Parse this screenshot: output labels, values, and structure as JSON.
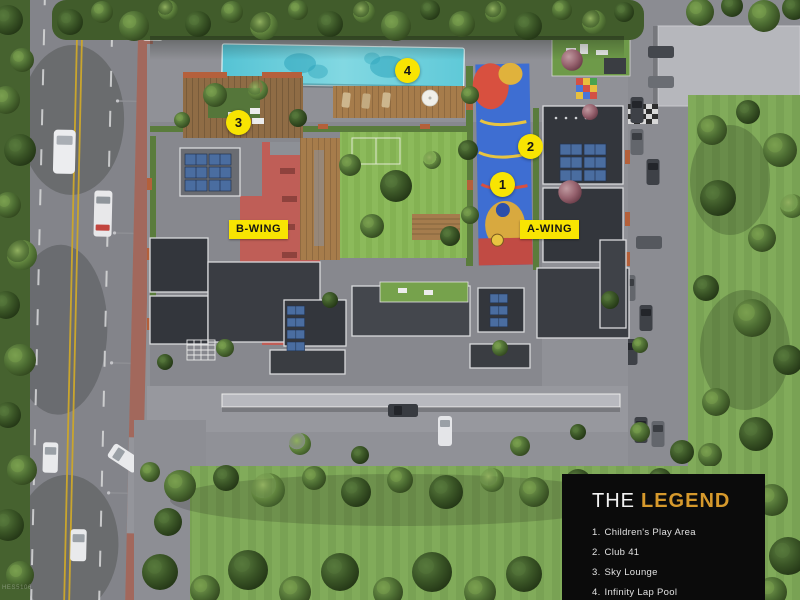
{
  "page": {
    "type": "aerial-site-plan-render"
  },
  "wings": [
    {
      "label": "B-WING"
    },
    {
      "label": "A-WING"
    }
  ],
  "markers": [
    {
      "number": "1"
    },
    {
      "number": "2"
    },
    {
      "number": "3"
    },
    {
      "number": "4"
    }
  ],
  "legend": {
    "title_prefix": "THE",
    "title_accent": "LEGEND",
    "items": [
      {
        "number": "1.",
        "label": "Children's Play Area"
      },
      {
        "number": "2.",
        "label": "Club 41"
      },
      {
        "number": "3.",
        "label": "Sky Lounge"
      },
      {
        "number": "4.",
        "label": "Infinity Lap Pool"
      }
    ]
  },
  "watermark": {
    "text": "HES5106"
  },
  "colors": {
    "highlight_yellow": "#F8E402",
    "legend_background": "#0B0B0B",
    "legend_accent": "#D6992C",
    "legend_text": "#E0E0E0",
    "pool_cyan": "#63CBD9",
    "lawn_green": "#84B253",
    "terrace_red": "#BF5E57"
  }
}
